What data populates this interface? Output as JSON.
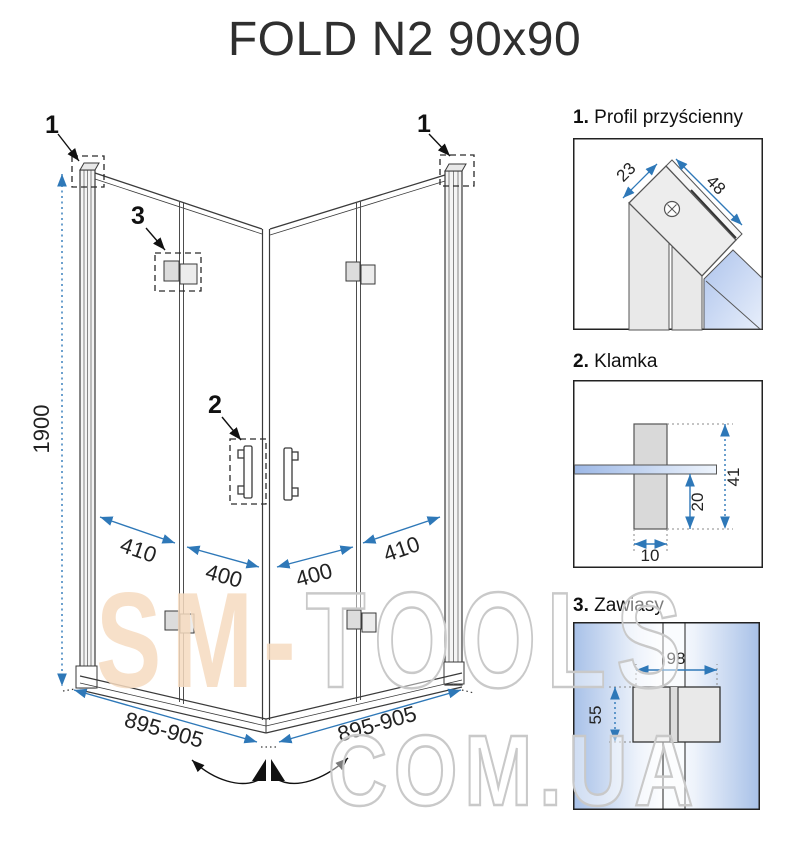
{
  "title": "FOLD N2 90x90",
  "main": {
    "callout_1_left": "1",
    "callout_1_right": "1",
    "callout_2": "2",
    "callout_3": "3",
    "dim_height": "1900",
    "dim_left_outer": "410",
    "dim_left_inner": "400",
    "dim_right_inner": "400",
    "dim_right_outer": "410",
    "dim_base_left": "895-905",
    "dim_base_right": "895-905"
  },
  "details": [
    {
      "num": "1.",
      "name": "Profil przyścienny",
      "dim_a": "23",
      "dim_b": "48"
    },
    {
      "num": "2.",
      "name": "Klamka",
      "dim_width": "10",
      "dim_lower": "20",
      "dim_total": "41"
    },
    {
      "num": "3.",
      "name": "Zawiasy",
      "dim_width": "98",
      "dim_height": "55"
    }
  ],
  "watermark": {
    "part1": "SM-",
    "part2": "TOOLS",
    "line2": "COM.UA"
  },
  "colors": {
    "dimension_blue": "#2e78b8",
    "line_dark": "#3a3a3a",
    "fill_gray": "#dcdcdc",
    "glass_blue": "#b3c7ee",
    "watermark_peach": "#f6dbc0",
    "watermark_outline": "#c9c9c9"
  }
}
